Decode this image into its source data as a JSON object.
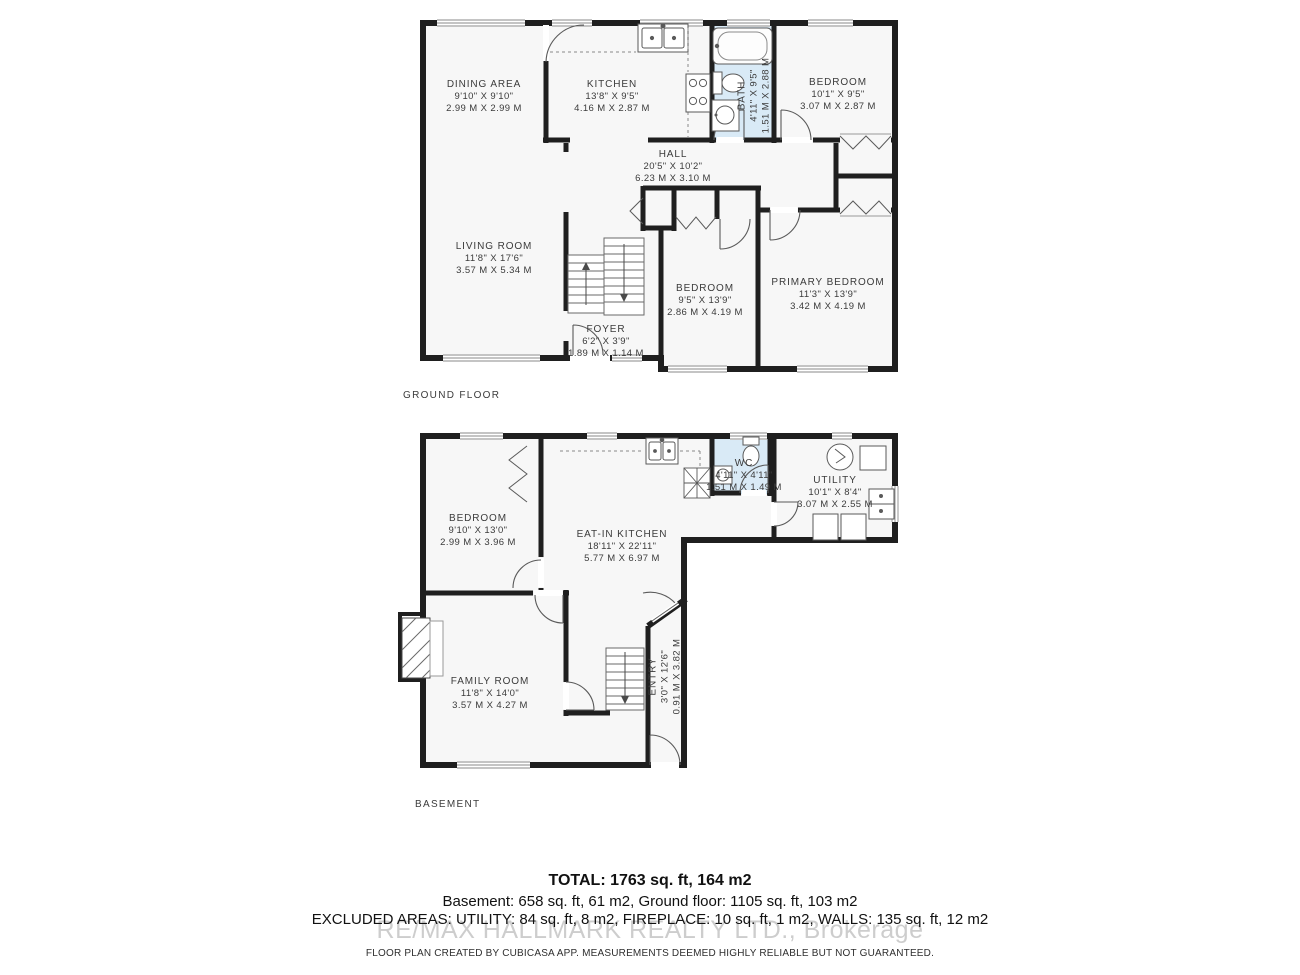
{
  "colors": {
    "wall": "#1f1f1f",
    "wet_room_fill": "#d9eaf6",
    "floor_fill": "#f7f7f7",
    "label_text": "#3b3b3b",
    "watermark_gray": "#bdbdbd"
  },
  "ground_floor": {
    "label": "GROUND FLOOR",
    "rooms": [
      {
        "name": "DINING AREA",
        "dims_ft": "9'10\" X 9'10\"",
        "dims_m": "2.99 M X 2.99 M"
      },
      {
        "name": "KITCHEN",
        "dims_ft": "13'8\" X 9'5\"",
        "dims_m": "4.16 M X 2.87 M"
      },
      {
        "name": "BATH",
        "dims_ft": "4'11\" X 9'5\"",
        "dims_m": "1.51 M X 2.88 M"
      },
      {
        "name": "BEDROOM",
        "dims_ft": "10'1\" X 9'5\"",
        "dims_m": "3.07 M X 2.87 M"
      },
      {
        "name": "HALL",
        "dims_ft": "20'5\" X 10'2\"",
        "dims_m": "6.23 M X 3.10 M"
      },
      {
        "name": "LIVING ROOM",
        "dims_ft": "11'8\" X 17'6\"",
        "dims_m": "3.57 M X 5.34 M"
      },
      {
        "name": "BEDROOM",
        "dims_ft": "9'5\" X 13'9\"",
        "dims_m": "2.86 M X 4.19 M"
      },
      {
        "name": "PRIMARY BEDROOM",
        "dims_ft": "11'3\" X 13'9\"",
        "dims_m": "3.42 M X 4.19 M"
      },
      {
        "name": "FOYER",
        "dims_ft": "6'2\" X 3'9\"",
        "dims_m": "1.89 M X 1.14 M"
      }
    ],
    "fixtures": [
      "kitchen-sink",
      "stove",
      "bathtub",
      "toilet",
      "pedestal-sink",
      "staircase",
      "closets"
    ]
  },
  "basement": {
    "label": "BASEMENT",
    "rooms": [
      {
        "name": "BEDROOM",
        "dims_ft": "9'10\" X 13'0\"",
        "dims_m": "2.99 M X 3.96 M"
      },
      {
        "name": "EAT-IN KITCHEN",
        "dims_ft": "18'11\" X 22'11\"",
        "dims_m": "5.77 M X 6.97 M"
      },
      {
        "name": "WC",
        "dims_ft": "4'11\" X 4'11\"",
        "dims_m": "1.51 M X 1.49 M"
      },
      {
        "name": "UTILITY",
        "dims_ft": "10'1\" X 8'4\"",
        "dims_m": "3.07 M X 2.55 M"
      },
      {
        "name": "FAMILY ROOM",
        "dims_ft": "11'8\" X 14'0\"",
        "dims_m": "3.57 M X 4.27 M"
      },
      {
        "name": "ENTRY",
        "dims_ft": "3'0\" X 12'6\"",
        "dims_m": "0.91 M X 3.82 M"
      }
    ],
    "fixtures": [
      "kitchen-sink",
      "toilet",
      "corner-sink",
      "water-heater",
      "furnace",
      "laundry-sink",
      "washer",
      "dryer",
      "staircase",
      "fireplace"
    ]
  },
  "summary": {
    "total": "TOTAL: 1763 sq. ft, 164 m2",
    "floors_line": "Basement: 658 sq. ft, 61 m2, Ground floor: 1105 sq. ft, 103 m2",
    "excluded_line": "EXCLUDED AREAS: UTILITY: 84 sq. ft, 8 m2, FIREPLACE: 10 sq. ft, 1 m2, WALLS: 135 sq. ft, 12 m2",
    "watermark": "RE/MAX HALLMARK REALTY LTD., Brokerage",
    "disclaimer": "FLOOR PLAN CREATED BY CUBICASA APP. MEASUREMENTS DEEMED HIGHLY RELIABLE BUT NOT GUARANTEED."
  }
}
